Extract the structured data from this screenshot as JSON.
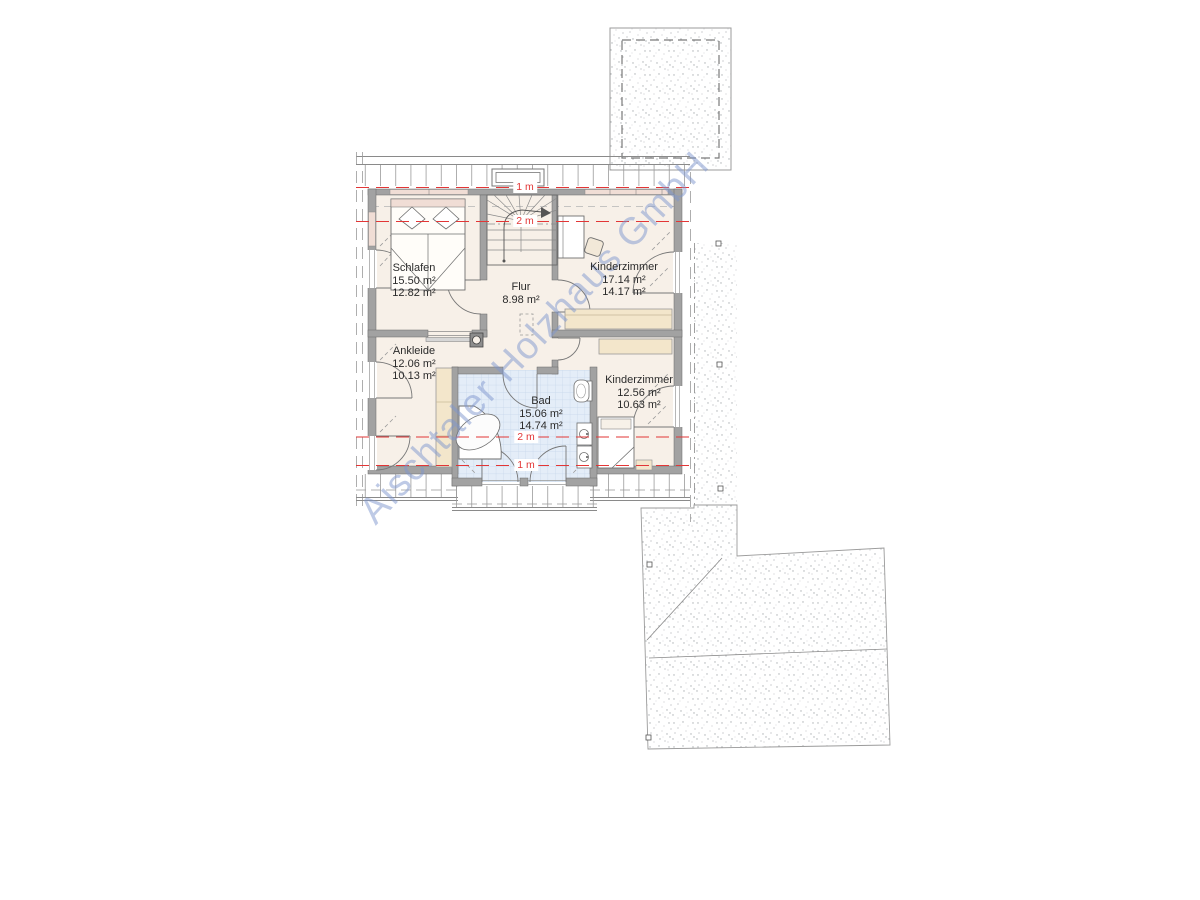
{
  "watermark": "Aischtaler Holzhaus GmbH",
  "rooms": [
    {
      "name": "Schlafen",
      "area_gross": "15.50 m²",
      "area_net": "12.82 m²"
    },
    {
      "name": "Flur",
      "area_gross": "8.98 m²",
      "area_net": ""
    },
    {
      "name": "Kinderzimmer",
      "area_gross": "17.14 m²",
      "area_net": "14.17 m²"
    },
    {
      "name": "Ankleide",
      "area_gross": "12.06 m²",
      "area_net": "10.13 m²"
    },
    {
      "name": "Bad",
      "area_gross": "15.06 m²",
      "area_net": "14.74 m²"
    },
    {
      "name": "Kinderzimmer",
      "area_gross": "12.56 m²",
      "area_net": "10.63 m²"
    }
  ],
  "height_labels": {
    "one_meter": "1 m",
    "two_meter": "2 m"
  },
  "colors": {
    "height_line": "#e23636",
    "floor": "#f7f0e8",
    "bath_floor": "#e4edf8",
    "wall": "#a2a2a2",
    "furniture_wood": "#f3e6cb",
    "window_sill": "#f0ddd5",
    "watermark_blue": "#7e96ce"
  }
}
